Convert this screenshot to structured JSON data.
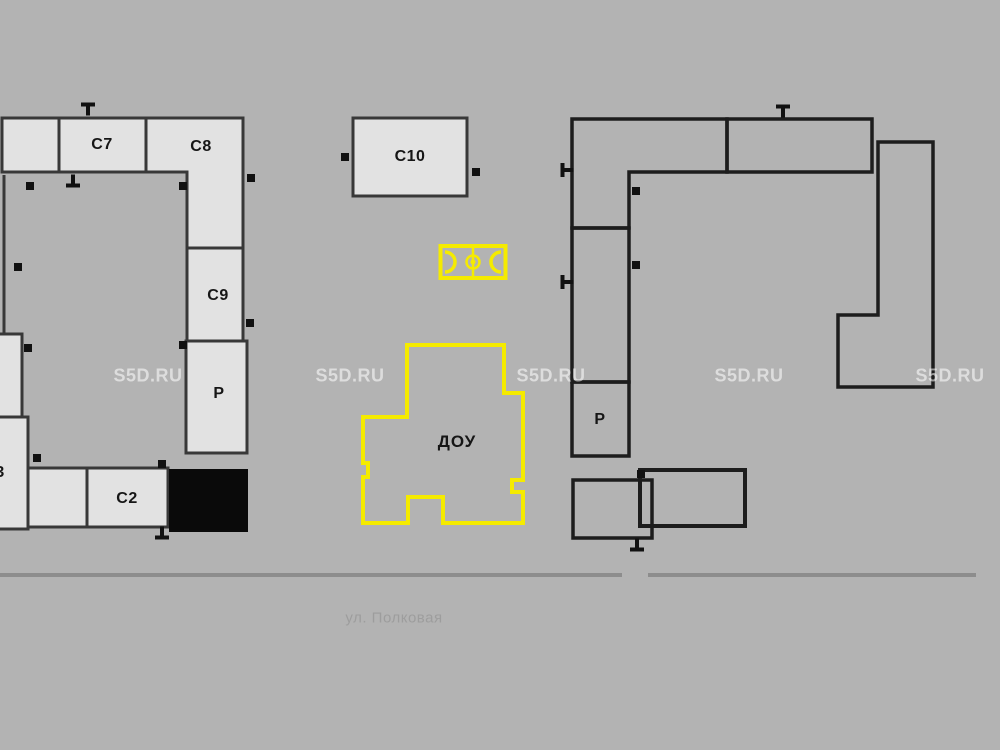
{
  "plan": {
    "labels": {
      "c7": "С7",
      "c8": "С8",
      "c9": "С9",
      "c10": "С10",
      "c2": "С2",
      "p_left": "Р",
      "p_right": "Р",
      "dou": "ДОУ",
      "partial_upper": "5",
      "partial_lower": "С3"
    },
    "street": {
      "name": "ул. Полковая"
    },
    "watermark": {
      "text": "S5D.RU"
    },
    "colors": {
      "background": "#b3b3b3",
      "building_fill": "#e2e2e2",
      "outline_left": "#383838",
      "outline_right": "#1d1d1d",
      "black_block": "#0a0a0a",
      "highlight_yellow": "#f5eb00",
      "street_line": "#8d8d8d",
      "street_text": "#9d9d9d",
      "label_text": "#161616"
    },
    "icons": {
      "sport_field": "football-pitch-icon",
      "entrance_marker": "entrance-tick-icon"
    }
  },
  "markers": [
    {
      "x": 88,
      "y": 109,
      "t": "t-up"
    },
    {
      "x": 73,
      "y": 181,
      "t": "t-down"
    },
    {
      "x": 30,
      "y": 186,
      "t": "sq"
    },
    {
      "x": 183,
      "y": 186,
      "t": "sq"
    },
    {
      "x": 251,
      "y": 178,
      "t": "sq"
    },
    {
      "x": 250,
      "y": 323,
      "t": "sq"
    },
    {
      "x": 18,
      "y": 267,
      "t": "sq"
    },
    {
      "x": 28,
      "y": 348,
      "t": "sq"
    },
    {
      "x": 37,
      "y": 458,
      "t": "sq"
    },
    {
      "x": 162,
      "y": 464,
      "t": "sq"
    },
    {
      "x": 162,
      "y": 533,
      "t": "t-down"
    },
    {
      "x": 183,
      "y": 345,
      "t": "sq"
    },
    {
      "x": 345,
      "y": 157,
      "t": "sq"
    },
    {
      "x": 476,
      "y": 172,
      "t": "sq"
    },
    {
      "x": 783,
      "y": 111,
      "t": "t-up"
    },
    {
      "x": 567,
      "y": 170,
      "t": "t-left"
    },
    {
      "x": 636,
      "y": 191,
      "t": "sq"
    },
    {
      "x": 567,
      "y": 282,
      "t": "t-left"
    },
    {
      "x": 636,
      "y": 265,
      "t": "sq"
    },
    {
      "x": 641,
      "y": 474,
      "t": "sq"
    },
    {
      "x": 637,
      "y": 545,
      "t": "t-down"
    }
  ],
  "watermark_positions": [
    {
      "x": 148,
      "y": 376
    },
    {
      "x": 350,
      "y": 376
    },
    {
      "x": 551,
      "y": 376
    },
    {
      "x": 749,
      "y": 376
    },
    {
      "x": 950,
      "y": 376
    }
  ]
}
